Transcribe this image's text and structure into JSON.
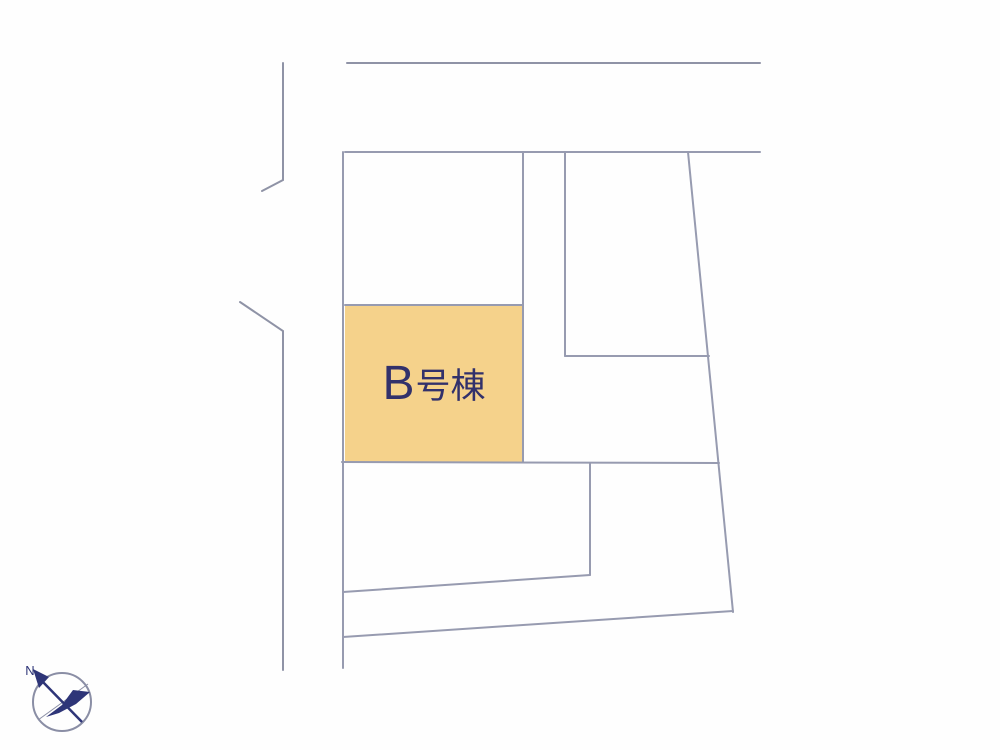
{
  "colors": {
    "background": "#fefefe",
    "line": "#979bb0",
    "road_line": "#8f93a6",
    "accent_fill": "#f5d28b",
    "label_text": "#32316b",
    "compass_navy": "#2e3578",
    "compass_gray": "#8a8ea5"
  },
  "site_plan": {
    "type": "real-estate-lot-layout-plan",
    "highlighted_lot": {
      "label": "B号棟",
      "label_letter": "B",
      "label_kanji": "号棟"
    }
  },
  "compass": {
    "north_label": "N"
  }
}
